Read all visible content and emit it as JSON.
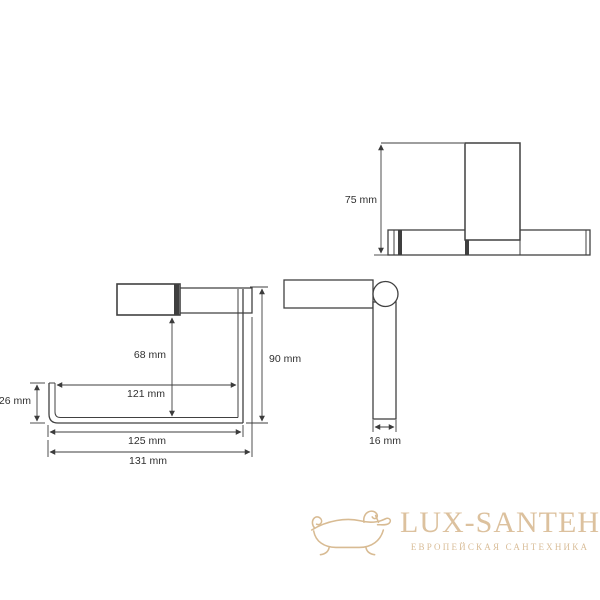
{
  "colors": {
    "background": "#ffffff",
    "line": "#414141",
    "dimension_line": "#3c3c3c",
    "dimension_text": "#303030",
    "gold": "#d9bd98",
    "gold_light": "#dcc19e"
  },
  "drawing": {
    "top_view": {
      "height": "75 mm"
    },
    "front_view": {
      "roll_drop": "68 mm",
      "inner_width": "121 mm",
      "hook_height": "26 mm",
      "overall_height": "90 mm",
      "arm_width": "125 mm",
      "overall_width": "131 mm"
    },
    "side_view": {
      "bar_depth": "16 mm"
    }
  },
  "watermark": {
    "brand": "LUX-SANTEH",
    "tagline": "ЕВРОПЕЙСКАЯ САНТЕХНИКА"
  }
}
